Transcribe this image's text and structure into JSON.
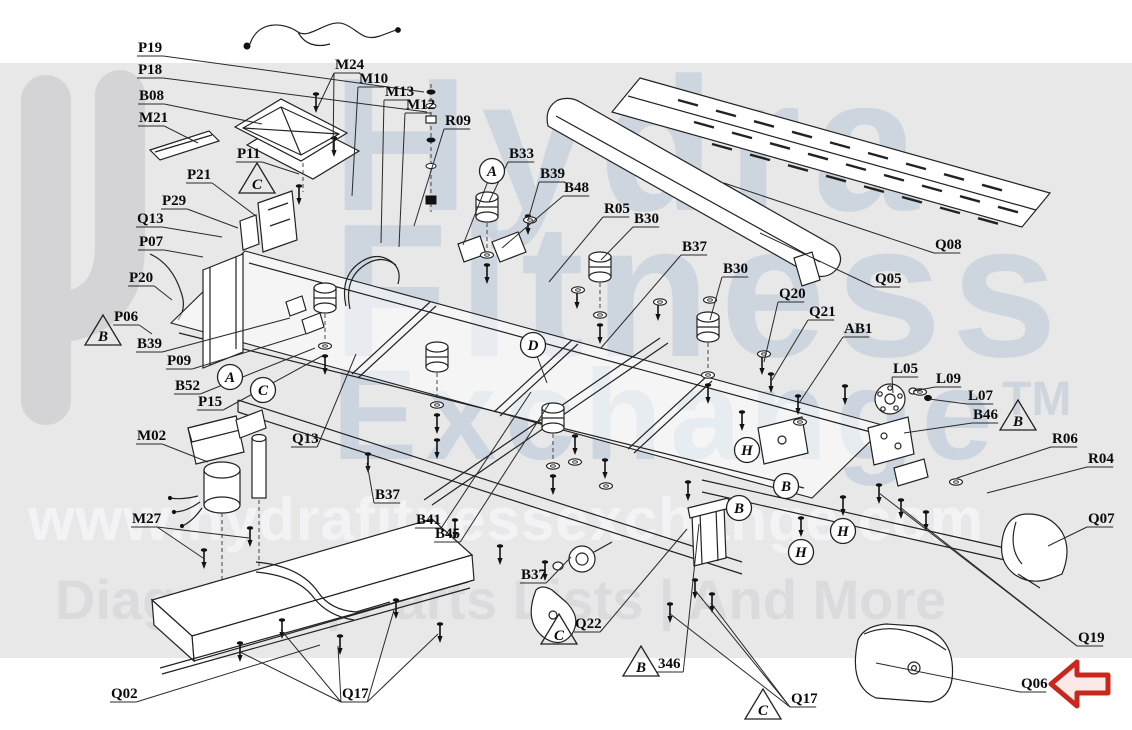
{
  "meta": {
    "width": 1132,
    "height": 730,
    "background": "#ffffff",
    "band_color": "#e8e8e8",
    "line_color": "#222222",
    "label_color": "#0a0a0a"
  },
  "watermark": {
    "word1": "Hydra",
    "word2": "Fitness",
    "word3": "Exchange",
    "tm": "TM",
    "url": "www.hydrafitnessexchange.com",
    "tagline": "Diagrams | Parts Lists | And More",
    "letter_color": "#c7d1de",
    "logo_color": "#d4d4d6"
  },
  "annotations": {
    "red_arrow": {
      "direction": "left",
      "points_at": "Q06",
      "stroke": "#c8271e",
      "fill": "#fbe9e7"
    }
  },
  "diagram": {
    "labels": [
      {
        "text": "P19",
        "x": 138,
        "y": 52,
        "tx": 424,
        "ty": 92
      },
      {
        "text": "P18",
        "x": 138,
        "y": 74,
        "tx": 427,
        "ty": 112
      },
      {
        "text": "B08",
        "x": 139,
        "y": 100,
        "tx": 262,
        "ty": 124
      },
      {
        "text": "M21",
        "x": 139,
        "y": 122,
        "tx": 198,
        "ty": 143
      },
      {
        "text": "M24",
        "x": 335,
        "y": 69,
        "targets": [
          [
            317,
            109
          ],
          [
            333,
            154
          ]
        ]
      },
      {
        "text": "M10",
        "x": 359,
        "y": 83,
        "tx": 352,
        "ty": 196
      },
      {
        "text": "M13",
        "x": 385,
        "y": 96,
        "tx": 381,
        "ty": 243
      },
      {
        "text": "M12",
        "x": 406,
        "y": 109,
        "tx": 399,
        "ty": 247
      },
      {
        "text": "R09",
        "x": 445,
        "y": 125,
        "tx": 414,
        "ty": 226
      },
      {
        "text": "P11",
        "x": 237,
        "y": 158,
        "tx": 299,
        "ty": 174
      },
      {
        "text": "P21",
        "x": 187,
        "y": 179,
        "tx": 256,
        "ty": 216
      },
      {
        "text": "P29",
        "x": 162,
        "y": 205,
        "tx": 238,
        "ty": 228
      },
      {
        "text": "Q13",
        "x": 137,
        "y": 223,
        "tx": 222,
        "ty": 237
      },
      {
        "text": "P07",
        "x": 139,
        "y": 246,
        "tx": 203,
        "ty": 257
      },
      {
        "text": "P20",
        "x": 129,
        "y": 282,
        "tx": 172,
        "ty": 300
      },
      {
        "text": "P06",
        "x": 114,
        "y": 321,
        "tx": 152,
        "ty": 334
      },
      {
        "text": "B39",
        "x": 137,
        "y": 348,
        "tx": 290,
        "ty": 318
      },
      {
        "text": "P09",
        "x": 167,
        "y": 365,
        "tx": 305,
        "ty": 334
      },
      {
        "text": "B52",
        "x": 175,
        "y": 390,
        "tx": 315,
        "ty": 348
      },
      {
        "text": "P15",
        "x": 198,
        "y": 406,
        "tx": 322,
        "ty": 356
      },
      {
        "text": "M02",
        "x": 137,
        "y": 440,
        "tx": 208,
        "ty": 462
      },
      {
        "text": "Q13",
        "x": 292,
        "y": 443,
        "tx": 356,
        "ty": 354
      },
      {
        "text": "M27",
        "x": 132,
        "y": 523,
        "targets": [
          [
            203,
            558
          ],
          [
            249,
            538
          ]
        ]
      },
      {
        "text": "B37",
        "x": 375,
        "y": 499,
        "tx": 367,
        "ty": 463
      },
      {
        "text": "B41",
        "x": 416,
        "y": 524,
        "tx": 531,
        "ty": 392
      },
      {
        "text": "B45",
        "x": 435,
        "y": 538,
        "tx": 549,
        "ty": 404
      },
      {
        "text": "Q02",
        "x": 111,
        "y": 698,
        "tx": 320,
        "ty": 645
      },
      {
        "text": "Q17",
        "x": 342,
        "y": 698,
        "targets": [
          [
            240,
            652
          ],
          [
            281,
            630
          ],
          [
            338,
            646
          ],
          [
            394,
            610
          ],
          [
            438,
            634
          ]
        ]
      },
      {
        "text": "B33",
        "x": 509,
        "y": 158,
        "tx": 489,
        "ty": 202
      },
      {
        "text": "B39",
        "x": 540,
        "y": 178,
        "tx": 528,
        "ty": 220
      },
      {
        "text": "B48",
        "x": 564,
        "y": 192,
        "tx": 502,
        "ty": 248
      },
      {
        "text": "R05",
        "x": 604,
        "y": 213,
        "tx": 549,
        "ty": 282
      },
      {
        "text": "B30",
        "x": 634,
        "y": 223,
        "tx": 601,
        "ty": 260
      },
      {
        "text": "B37",
        "x": 682,
        "y": 251,
        "tx": 601,
        "ty": 348
      },
      {
        "text": "B30",
        "x": 723,
        "y": 273,
        "tx": 710,
        "ty": 320
      },
      {
        "text": "Q08",
        "x": 935,
        "y": 249,
        "tx": 724,
        "ty": 183
      },
      {
        "text": "Q05",
        "x": 875,
        "y": 283,
        "tx": 760,
        "ty": 233
      },
      {
        "text": "Q20",
        "x": 779,
        "y": 298,
        "tx": 764,
        "ty": 362
      },
      {
        "text": "Q21",
        "x": 809,
        "y": 316,
        "tx": 772,
        "ty": 380
      },
      {
        "text": "AB1",
        "x": 844,
        "y": 333,
        "tx": 799,
        "ty": 403
      },
      {
        "text": "L05",
        "x": 893,
        "y": 373,
        "tx": 893,
        "ty": 393
      },
      {
        "text": "L09",
        "x": 936,
        "y": 383,
        "tx": 914,
        "ty": 391
      },
      {
        "text": "L07",
        "x": 968,
        "y": 400,
        "tx": 929,
        "ty": 399
      },
      {
        "text": "B46",
        "x": 973,
        "y": 419,
        "tx": 904,
        "ty": 433
      },
      {
        "text": "R06",
        "x": 1052,
        "y": 443,
        "tx": 957,
        "ty": 478
      },
      {
        "text": "R04",
        "x": 1088,
        "y": 463,
        "tx": 987,
        "ty": 493
      },
      {
        "text": "Q07",
        "x": 1088,
        "y": 523,
        "tx": 1048,
        "ty": 546
      },
      {
        "text": "B37",
        "x": 521,
        "y": 579,
        "tx": 571,
        "ty": 557
      },
      {
        "text": "Q22",
        "x": 575,
        "y": 628,
        "tx": 687,
        "ty": 529
      },
      {
        "text": "346",
        "x": 658,
        "y": 668,
        "tx": 699,
        "ty": 524
      },
      {
        "text": "Q17",
        "x": 791,
        "y": 703,
        "targets": [
          [
            694,
            589
          ],
          [
            711,
            603
          ],
          [
            669,
            613
          ]
        ]
      },
      {
        "text": "Q19",
        "x": 1078,
        "y": 642,
        "targets": [
          [
            879,
            493
          ],
          [
            901,
            508
          ]
        ]
      },
      {
        "text": "Q06",
        "x": 1021,
        "y": 688,
        "tx": 876,
        "ty": 663
      }
    ],
    "markers": {
      "triangles": [
        {
          "letter": "C",
          "x": 257,
          "y": 181
        },
        {
          "letter": "B",
          "x": 103,
          "y": 333
        },
        {
          "letter": "B",
          "x": 1018,
          "y": 418
        },
        {
          "letter": "C",
          "x": 559,
          "y": 632
        },
        {
          "letter": "B",
          "x": 641,
          "y": 664
        },
        {
          "letter": "C",
          "x": 763,
          "y": 707
        }
      ],
      "circles": [
        {
          "letter": "A",
          "x": 492,
          "y": 171,
          "tx": 463,
          "ty": 245
        },
        {
          "letter": "A",
          "x": 230,
          "y": 377
        },
        {
          "letter": "C",
          "x": 263,
          "y": 390
        },
        {
          "letter": "D",
          "x": 533,
          "y": 345,
          "tx": 547,
          "ty": 383
        },
        {
          "letter": "H",
          "x": 747,
          "y": 450
        },
        {
          "letter": "B",
          "x": 786,
          "y": 486
        },
        {
          "letter": "B",
          "x": 739,
          "y": 508
        },
        {
          "letter": "H",
          "x": 843,
          "y": 531
        },
        {
          "letter": "H",
          "x": 801,
          "y": 552
        }
      ]
    }
  }
}
